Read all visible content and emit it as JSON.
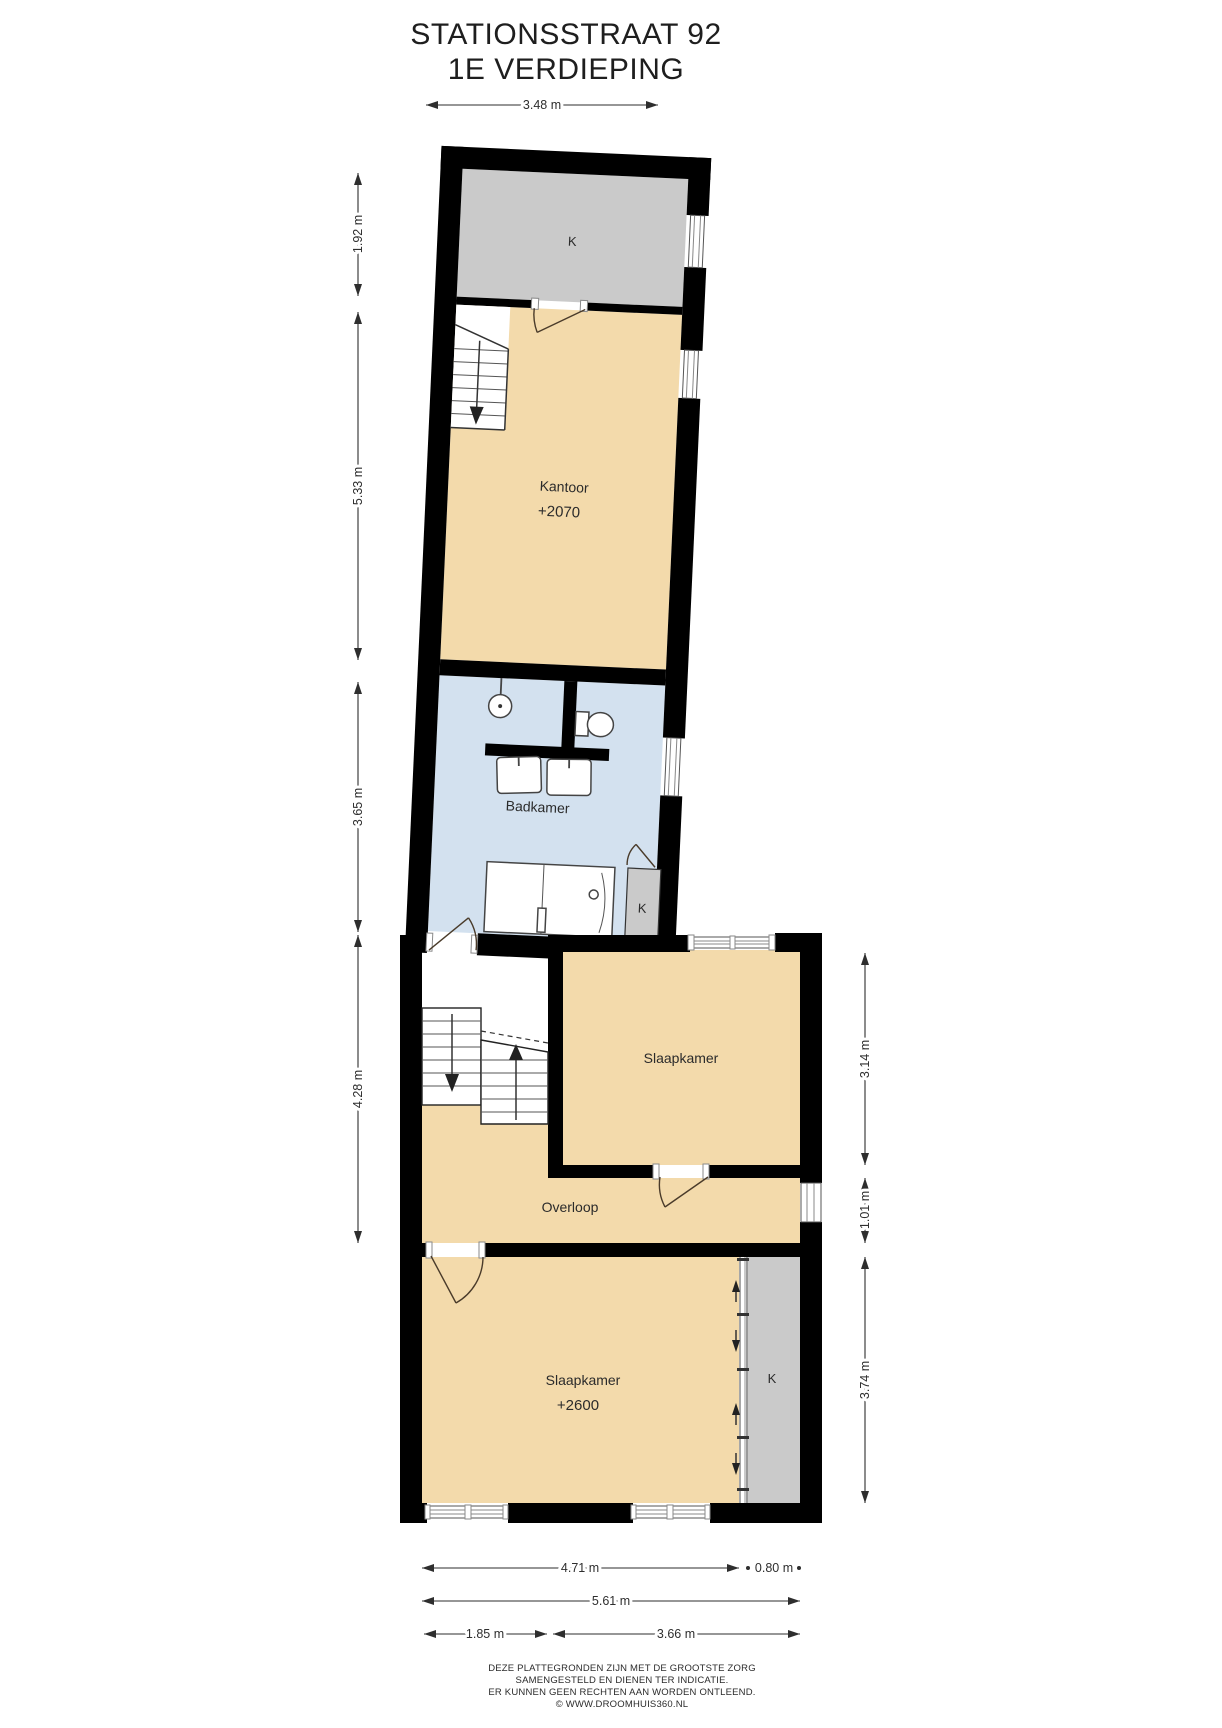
{
  "title": {
    "line1": "STATIONSSTRAAT 92",
    "line2": "1E VERDIEPING"
  },
  "rooms": {
    "closet_top": {
      "label": "K"
    },
    "kantoor": {
      "label": "Kantoor",
      "elevation": "+2070"
    },
    "badkamer": {
      "label": "Badkamer"
    },
    "closet_badkamer": {
      "label": "K"
    },
    "slaapkamer_boven": {
      "label": "Slaapkamer"
    },
    "overloop": {
      "label": "Overloop"
    },
    "slaapkamer_onder": {
      "label": "Slaapkamer",
      "elevation": "+2600"
    },
    "closet_slaapkamer": {
      "label": "K"
    }
  },
  "dimensions": {
    "top": "3.48 m",
    "left": [
      "1.92 m",
      "5.33 m",
      "3.65 m",
      "4.28 m"
    ],
    "right": [
      "3.14 m",
      "1.01 m",
      "3.74 m"
    ],
    "bottom_row1": [
      "4.71 m",
      "0.80 m"
    ],
    "bottom_row2": [
      "5.61 m"
    ],
    "bottom_row3": [
      "1.85 m",
      "3.66 m"
    ]
  },
  "footer": {
    "line1": "DEZE PLATTEGRONDEN ZIJN MET DE GROOTSTE ZORG",
    "line2": "SAMENGESTELD EN DIENEN TER INDICATIE.",
    "line3": "ER KUNNEN GEEN RECHTEN AAN WORDEN ONTLEEND.",
    "line4": "© WWW.DROOMHUIS360.NL"
  },
  "colors": {
    "wall": "#000000",
    "floor": "#F3DAAB",
    "bathroom_floor": "#D3E1EF",
    "closet": "#CACACA",
    "dimension_text": "#2E2E2E"
  }
}
